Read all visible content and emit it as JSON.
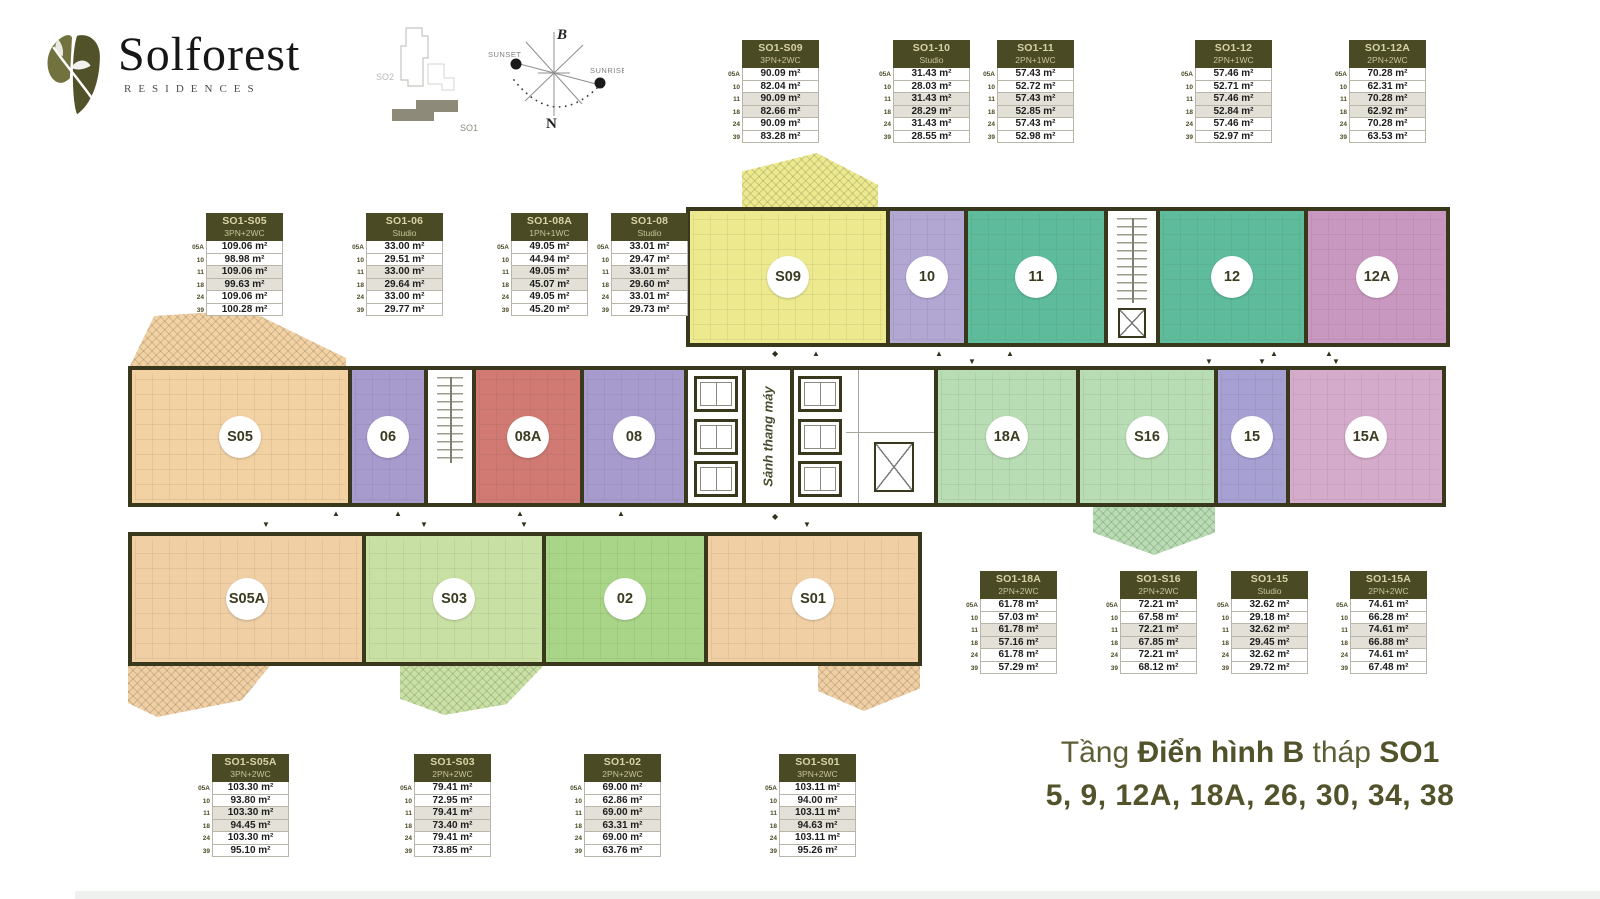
{
  "brand": {
    "name": "Solforest",
    "tagline": "RESIDENCES"
  },
  "site_map": {
    "tower_back": "SO2",
    "tower_front": "SO1"
  },
  "compass": {
    "north": "B",
    "south": "N",
    "west": "SUNSET",
    "east": "SUNRISE"
  },
  "floors": [
    "05A",
    "10",
    "11",
    "18",
    "24",
    "39"
  ],
  "tables": [
    {
      "title": "SO1-S09",
      "type": "3PN+2WC",
      "areas": [
        "90.09 m²",
        "82.04 m²",
        "90.09 m²",
        "82.66 m²",
        "90.09 m²",
        "83.28 m²"
      ]
    },
    {
      "title": "SO1-10",
      "type": "Studio",
      "areas": [
        "31.43 m²",
        "28.03 m²",
        "31.43 m²",
        "28.29 m²",
        "31.43 m²",
        "28.55 m²"
      ]
    },
    {
      "title": "SO1-11",
      "type": "2PN+1WC",
      "areas": [
        "57.43 m²",
        "52.72 m²",
        "57.43 m²",
        "52.85 m²",
        "57.43 m²",
        "52.98 m²"
      ]
    },
    {
      "title": "SO1-12",
      "type": "2PN+1WC",
      "areas": [
        "57.46 m²",
        "52.71 m²",
        "57.46 m²",
        "52.84 m²",
        "57.46 m²",
        "52.97 m²"
      ]
    },
    {
      "title": "SO1-12A",
      "type": "2PN+2WC",
      "areas": [
        "70.28 m²",
        "62.31 m²",
        "70.28 m²",
        "62.92 m²",
        "70.28 m²",
        "63.53 m²"
      ]
    },
    {
      "title": "SO1-S05",
      "type": "3PN+2WC",
      "areas": [
        "109.06 m²",
        "98.98 m²",
        "109.06 m²",
        "99.63 m²",
        "109.06 m²",
        "100.28 m²"
      ]
    },
    {
      "title": "SO1-06",
      "type": "Studio",
      "areas": [
        "33.00 m²",
        "29.51 m²",
        "33.00 m²",
        "29.64 m²",
        "33.00 m²",
        "29.77 m²"
      ]
    },
    {
      "title": "SO1-08A",
      "type": "1PN+1WC",
      "areas": [
        "49.05 m²",
        "44.94 m²",
        "49.05 m²",
        "45.07 m²",
        "49.05 m²",
        "45.20 m²"
      ]
    },
    {
      "title": "SO1-08",
      "type": "Studio",
      "areas": [
        "33.01 m²",
        "29.47 m²",
        "33.01 m²",
        "29.60 m²",
        "33.01 m²",
        "29.73 m²"
      ]
    },
    {
      "title": "SO1-18A",
      "type": "2PN+2WC",
      "areas": [
        "61.78 m²",
        "57.03 m²",
        "61.78 m²",
        "57.16 m²",
        "61.78 m²",
        "57.29 m²"
      ]
    },
    {
      "title": "SO1-S16",
      "type": "2PN+2WC",
      "areas": [
        "72.21 m²",
        "67.58 m²",
        "72.21 m²",
        "67.85 m²",
        "72.21 m²",
        "68.12 m²"
      ]
    },
    {
      "title": "SO1-15",
      "type": "Studio",
      "areas": [
        "32.62 m²",
        "29.18 m²",
        "32.62 m²",
        "29.45 m²",
        "32.62 m²",
        "29.72 m²"
      ]
    },
    {
      "title": "SO1-15A",
      "type": "2PN+2WC",
      "areas": [
        "74.61 m²",
        "66.28 m²",
        "74.61 m²",
        "66.88 m²",
        "74.61 m²",
        "67.48 m²"
      ]
    },
    {
      "title": "SO1-S05A",
      "type": "3PN+2WC",
      "areas": [
        "103.30 m²",
        "93.80 m²",
        "103.30 m²",
        "94.45 m²",
        "103.30 m²",
        "95.10 m²"
      ]
    },
    {
      "title": "SO1-S03",
      "type": "2PN+2WC",
      "areas": [
        "79.41 m²",
        "72.95 m²",
        "79.41 m²",
        "73.40 m²",
        "79.41 m²",
        "73.85 m²"
      ]
    },
    {
      "title": "SO1-02",
      "type": "2PN+2WC",
      "areas": [
        "69.00 m²",
        "62.86 m²",
        "69.00 m²",
        "63.31 m²",
        "69.00 m²",
        "63.76 m²"
      ]
    },
    {
      "title": "SO1-S01",
      "type": "3PN+2WC",
      "areas": [
        "103.11 m²",
        "94.00 m²",
        "103.11 m²",
        "94.63 m²",
        "103.11 m²",
        "95.26 m²"
      ]
    }
  ],
  "plan": {
    "core_label": "Sảnh thang máy",
    "units": [
      {
        "label": "S09",
        "fill": "#ece98f"
      },
      {
        "label": "10",
        "fill": "#b2a7d3"
      },
      {
        "label": "11",
        "fill": "#5ebc9d"
      },
      {
        "label": "12",
        "fill": "#5ebc9d"
      },
      {
        "label": "12A",
        "fill": "#c998c1"
      },
      {
        "label": "S05",
        "fill": "#f2d1a3"
      },
      {
        "label": "06",
        "fill": "#a79bce"
      },
      {
        "label": "08A",
        "fill": "#d07a73"
      },
      {
        "label": "08",
        "fill": "#a79bce"
      },
      {
        "label": "18A",
        "fill": "#b8dcb3"
      },
      {
        "label": "S16",
        "fill": "#b8dcb3"
      },
      {
        "label": "15",
        "fill": "#a7a0d3"
      },
      {
        "label": "15A",
        "fill": "#d5abcc"
      },
      {
        "label": "S05A",
        "fill": "#f0cfa4"
      },
      {
        "label": "S03",
        "fill": "#c8e0a4"
      },
      {
        "label": "02",
        "fill": "#a9d588"
      },
      {
        "label": "S01",
        "fill": "#f0cfa4"
      }
    ]
  },
  "footer": {
    "word1": "Tầng",
    "word2": "Điển hình B",
    "word3": "tháp",
    "word4": "SO1",
    "floors_list": "5, 9, 12A, 18A, 26, 30, 34, 38"
  },
  "colors": {
    "wall": "#3a381c",
    "table_header_bg": "#4a4a24",
    "table_header_text": "#d8d3a6",
    "row_shaded": "#e3e0d7",
    "footer_text": "#5e5e36",
    "brand_leaf_dark": "#51512a",
    "brand_leaf_light": "#72723f",
    "site_tower_filled": "#8e8a7a"
  }
}
